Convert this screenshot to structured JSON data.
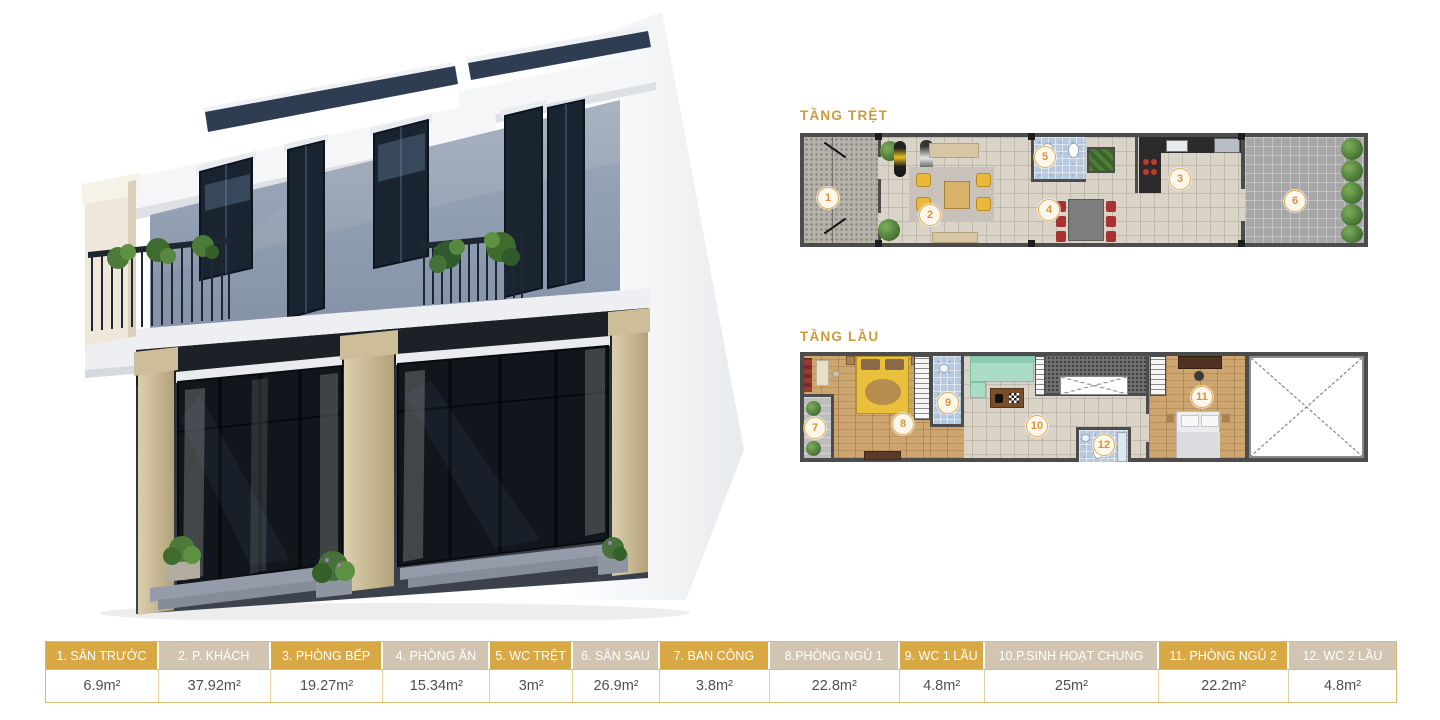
{
  "plans": {
    "ground": {
      "label": "TẦNG TRỆT",
      "markers": [
        "1",
        "2",
        "3",
        "4",
        "5",
        "6"
      ]
    },
    "upper": {
      "label": "TẦNG LẦU",
      "markers": [
        "7",
        "8",
        "9",
        "10",
        "11",
        "12"
      ]
    }
  },
  "legend": {
    "columns": [
      {
        "header": "1. SÂN TRƯỚC",
        "value": "6.9m²"
      },
      {
        "header": "2. P. KHÁCH",
        "value": "37.92m²"
      },
      {
        "header": "3. PHÒNG BẾP",
        "value": "19.27m²"
      },
      {
        "header": "4. PHÒNG ĂN",
        "value": "15.34m²"
      },
      {
        "header": "5. WC TRỆT",
        "value": "3m²"
      },
      {
        "header": "6. SÂN SAU",
        "value": "26.9m²"
      },
      {
        "header": "7. BAN CÔNG",
        "value": "3.8m²"
      },
      {
        "header": "8.PHÒNG NGỦ 1",
        "value": "22.8m²"
      },
      {
        "header": "9. WC 1 LẦU",
        "value": "4.8m²"
      },
      {
        "header": "10.P.SINH HOẠT CHUNG",
        "value": "25m²"
      },
      {
        "header": "11. PHÒNG NGỦ 2",
        "value": "22.2m²"
      },
      {
        "header": "12. WC 2 LẦU",
        "value": "4.8m²"
      }
    ]
  },
  "colors": {
    "accent_gold": "#d8a845",
    "accent_beige": "#d1c5b1",
    "label_gold": "#cf9a3c",
    "wall_dark": "#4c4c4c"
  }
}
